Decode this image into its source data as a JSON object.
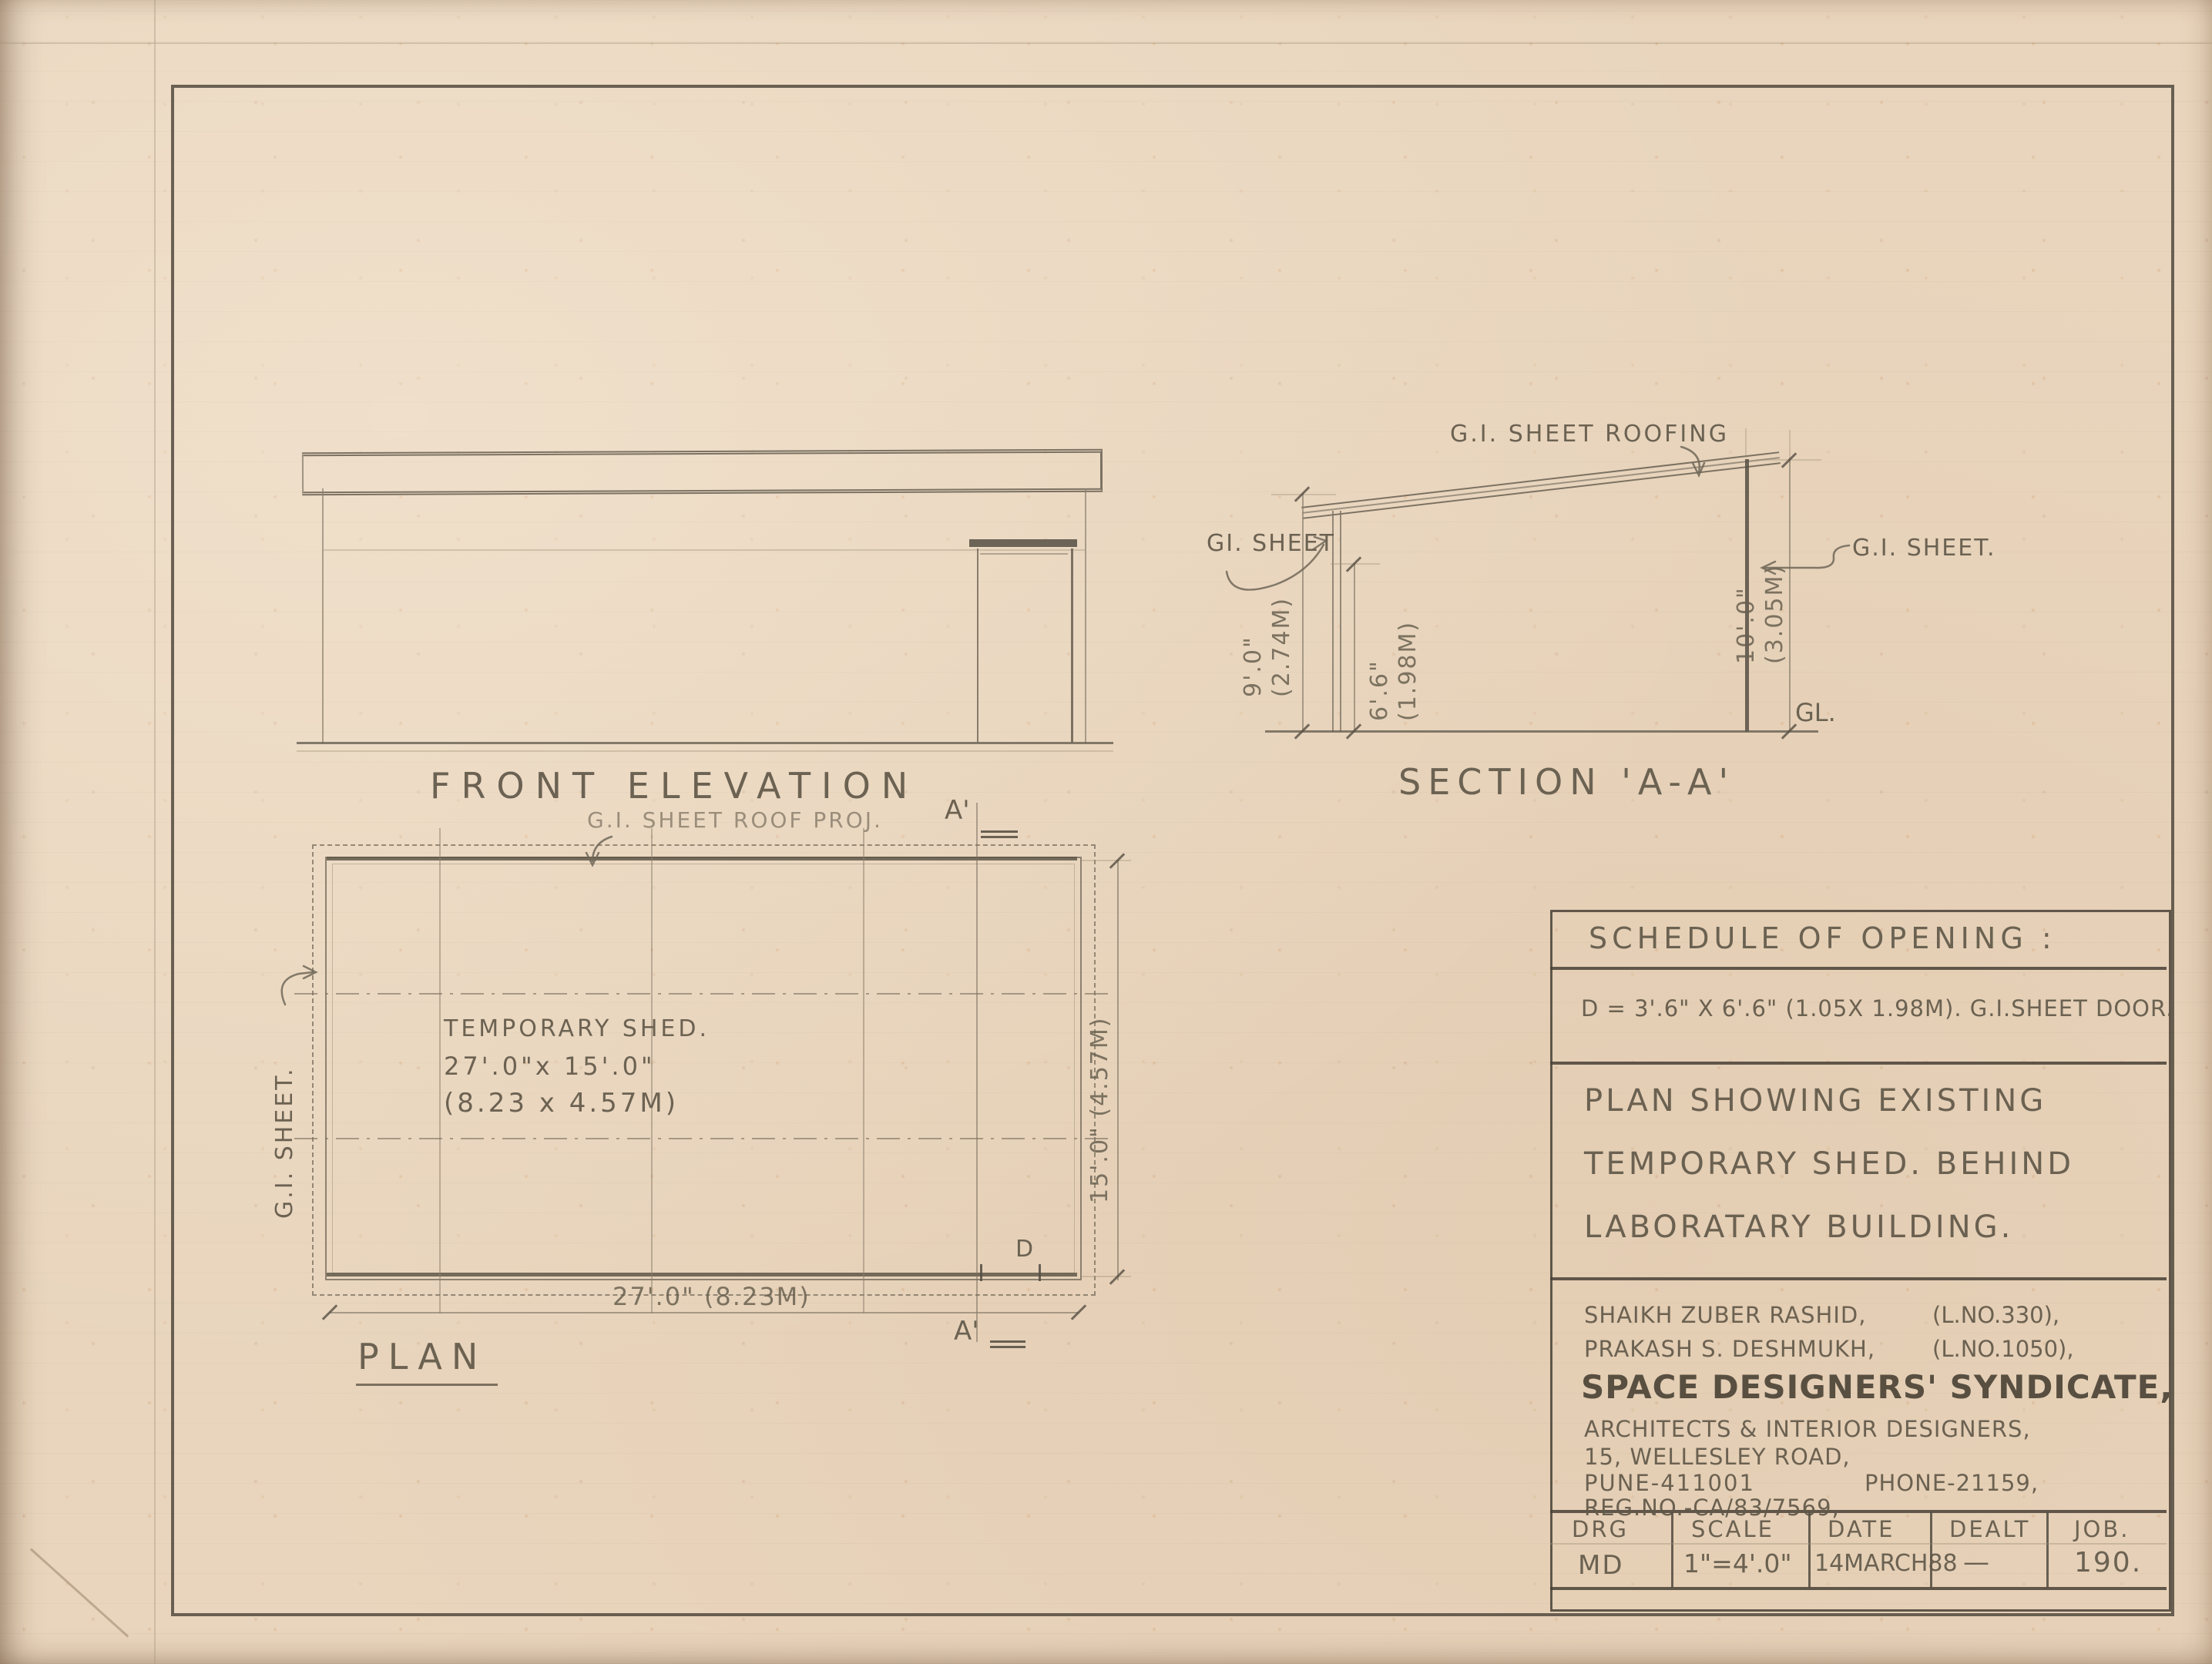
{
  "colors": {
    "paper": "#e9d5bd",
    "pencil_dark": "#564f43",
    "pencil_medium": "#7d7465",
    "pencil_light": "#a89c88",
    "text": "#615849"
  },
  "front_elevation": {
    "label": "FRONT ELEVATION"
  },
  "section": {
    "label": "SECTION 'A-A'",
    "roof_label": "G.I. SHEET ROOFING",
    "left_wall_label": "GI. SHEET",
    "right_wall_label": "G.I. SHEET.",
    "ground_label": "GL.",
    "dim_left_ft": "9'.0\"",
    "dim_left_m": "(2.74M)",
    "dim_inner_ft": "6'.6\"",
    "dim_inner_m": "(1.98M)",
    "dim_right_ft": "10'.0\"",
    "dim_right_m": "(3.05M)"
  },
  "plan": {
    "label": "PLAN",
    "roof_proj_label": "G.I. SHEET ROOF PROJ.",
    "left_wall_label": "G.I. SHEET.",
    "shed_line1": "TEMPORARY SHED.",
    "shed_line2": "27'.0\"x 15'.0\"",
    "shed_line3": "(8.23 x 4.57M)",
    "dim_width": "27'.0\" (8.23M)",
    "dim_depth": "15'.0\" (4.57M)",
    "section_marker": "A'",
    "door_label": "D"
  },
  "title_block": {
    "schedule_heading": "SCHEDULE OF OPENING :",
    "schedule_entry": "D = 3'.6\" X 6'.6\" (1.05X 1.98M). G.I.SHEET DOOR.",
    "drawing_title_line1": "PLAN SHOWING EXISTING",
    "drawing_title_line2": "TEMPORARY SHED. BEHIND",
    "drawing_title_line3": "LABORATARY BUILDING.",
    "architect1": "SHAIKH ZUBER RASHID,",
    "architect1_licence": "(L.NO.330),",
    "architect2": "PRAKASH S. DESHMUKH,",
    "architect2_licence": "(L.NO.1050),",
    "firm_name": "SPACE DESIGNERS' SYNDICATE,",
    "firm_subtitle": "ARCHITECTS & INTERIOR DESIGNERS,",
    "address_line1": "15, WELLESLEY ROAD,",
    "address_city": "PUNE-411001",
    "phone": "PHONE-21159,",
    "reg_no": "REG.NO.-CA/83/7569,",
    "table": {
      "headers": [
        "DRG",
        "SCALE",
        "DATE",
        "DEALT",
        "JOB."
      ],
      "values": [
        "MD",
        "1\"=4'.0\"",
        "14MARCH88",
        "—",
        "190."
      ]
    }
  }
}
